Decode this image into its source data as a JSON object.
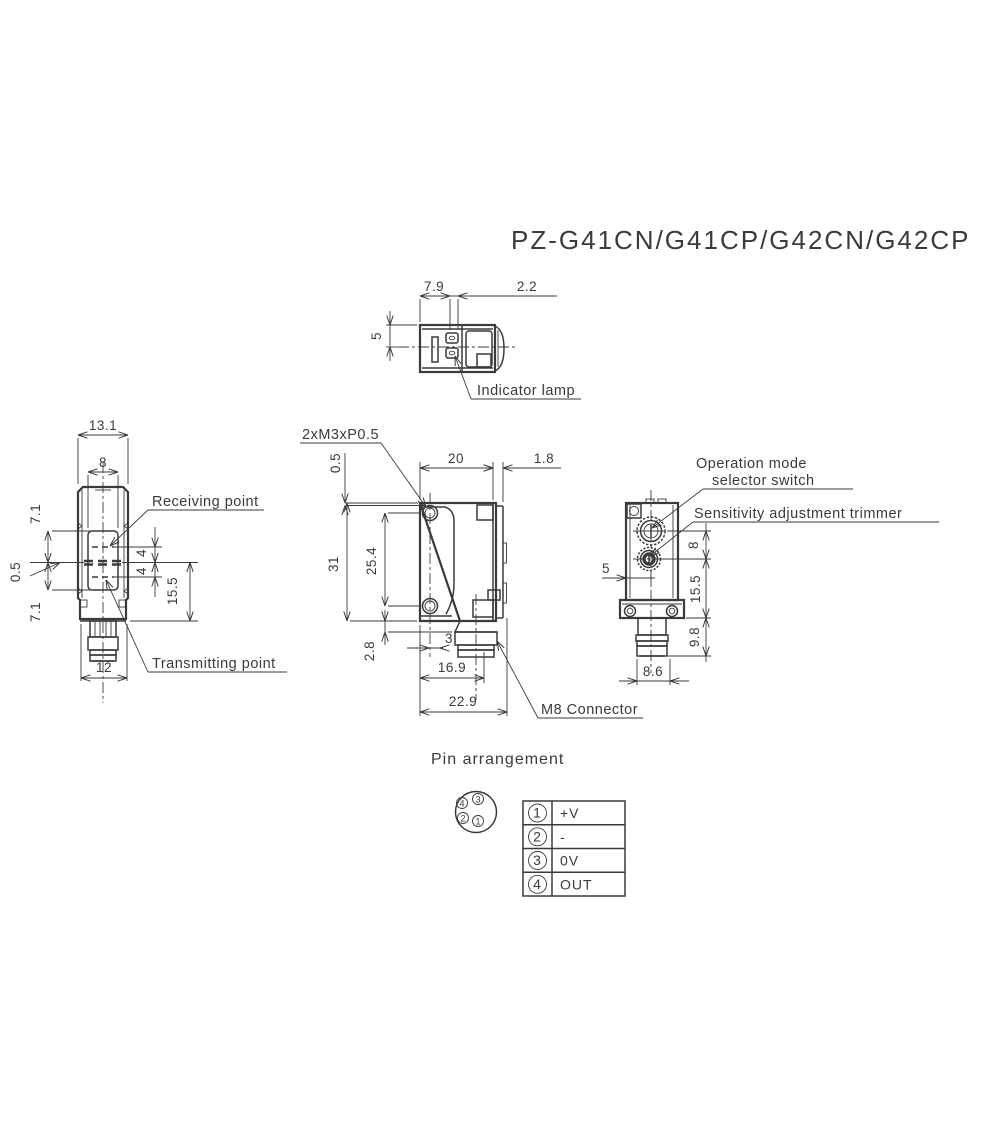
{
  "title": "PZ-G41CN/G41CP/G42CN/G42CP",
  "colors": {
    "line": "#3a3a3a",
    "background": "#ffffff"
  },
  "top_view": {
    "dim_front_width": "7.9",
    "dim_lamp_offset": "2.2",
    "dim_height": "5",
    "indicator_lamp_label": "Indicator lamp"
  },
  "front_view": {
    "dim_overall_width": "13.1",
    "dim_lens_width": "8",
    "dim_upper": "7.1",
    "dim_beam_gap": "0.5",
    "dim_lower": "7.1",
    "dim_receiving_offset": "4",
    "dim_transmitting_offset": "4",
    "dim_lower_height": "15.5",
    "dim_connector_width": "12",
    "receiving_point_label": "Receiving point",
    "transmitting_point_label": "Transmitting point"
  },
  "side_view": {
    "screw_hole_label": "2xM3xP0.5",
    "dim_hole_top_offset": "0.5",
    "dim_body_depth": "20",
    "dim_front_plate": "1.8",
    "dim_body_height": "31",
    "dim_hole_pitch": "25.4",
    "dim_bottom_offset": "2.8",
    "dim_connector_offset": "3",
    "dim_connector_depth": "16.9",
    "dim_overall_depth": "22.9",
    "m8_connector_label": "M8 Connector"
  },
  "rear_view": {
    "operation_mode_label_line1": "Operation mode",
    "operation_mode_label_line2": "selector switch",
    "sensitivity_label": "Sensitivity adjustment trimmer",
    "dim_center_offset": "5",
    "dim_knob_pitch": "8",
    "dim_lower_height": "15.5",
    "dim_connector_height": "9.8",
    "dim_connector_width": "8.6"
  },
  "pin_arrangement": {
    "title": "Pin arrangement",
    "face_pins": [
      "1",
      "2",
      "3",
      "4"
    ],
    "table": [
      {
        "pin": "1",
        "signal": "+V"
      },
      {
        "pin": "2",
        "signal": "-"
      },
      {
        "pin": "3",
        "signal": "0V"
      },
      {
        "pin": "4",
        "signal": "OUT"
      }
    ]
  }
}
